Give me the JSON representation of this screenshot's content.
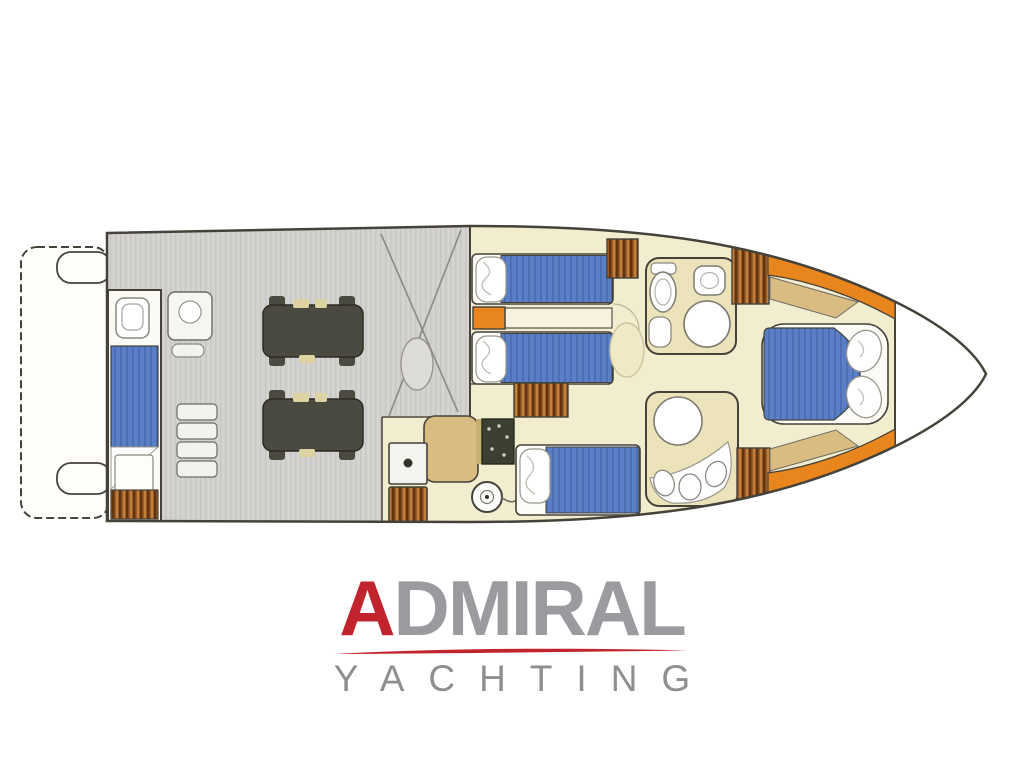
{
  "logo": {
    "brand_initial": "A",
    "brand_rest": "DMIRAL",
    "subtitle": "YACHTING"
  },
  "colors": {
    "logo_red": "#c2242e",
    "logo_gray": "#9b9a9e",
    "subtitle_gray": "#8f8f91",
    "outline": "#45423a",
    "floor_cream": "#f3edd0",
    "engine_gray": "#d4d3d0",
    "bed_blue": "#5b7fc6",
    "wardrobe_brown": "#9c5b26",
    "accent_orange": "#e8851c",
    "counter_tan": "#d9bc82",
    "bath_floor": "#ece3ba",
    "engine_dark": "#4b4a40"
  },
  "floorplan": {
    "type": "motor-yacht-lower-deck-plan",
    "parts": [
      "swim-platform",
      "crew-cabin",
      "engine-room",
      "companionway-stairs",
      "galley",
      "twin-guest-cabin",
      "mid-cabin",
      "upper-head",
      "lower-head",
      "wardrobes",
      "bow-owner-cabin",
      "bow-locker"
    ]
  }
}
